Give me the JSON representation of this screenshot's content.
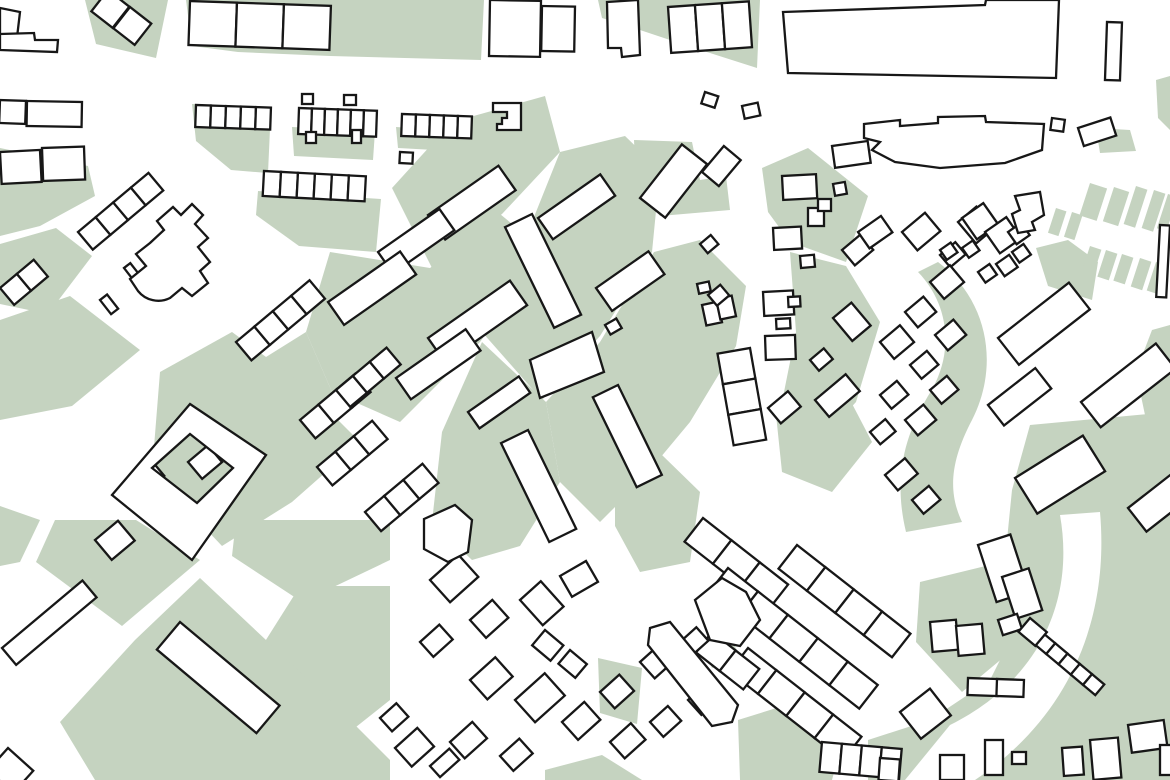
{
  "map": {
    "kind": "figure-ground-urban-map",
    "colors": {
      "background": "#ffffff",
      "open_space_green": "#c5d3c0",
      "building_fill": "#ffffff",
      "building_outline": "#171717"
    },
    "stroke_width": 2.3,
    "viewbox": "0 0 1170 780",
    "green_areas": {
      "polys": [
        "85,0 168,0 156,58 96,44",
        "186,0 484,0 481,60 330,56 238,52 192,46",
        "598,0 760,0 757,68 688,46 640,30 602,18",
        "192,104 271,107 268,173 231,170 196,141",
        "292,127 375,131 373,160 294,156",
        "396,127 474,132 471,152 398,148",
        "258,191 381,199 376,252 299,246 256,215",
        "0,148 88,166 95,196 40,226 0,236",
        "0,244 56,228 92,256 48,314 0,304",
        "392,188 452,122 545,96 560,152 502,214 432,268",
        "560,152 625,136 660,170 652,252 600,336 542,400 482,332 520,252",
        "330,252 430,268 500,214 546,252 480,342 400,422 332,392 306,332",
        "482,342 546,402 560,482 520,546 472,560 432,522 442,432",
        "560,482 546,402 600,342 654,252 700,240 746,286 736,346 690,422 640,482 600,522",
        "306,332 332,392 292,442 232,482 182,432 242,372",
        "0,320 70,296 140,350 72,406 0,420",
        "160,372 232,332 300,382 360,442 292,502 222,546 152,472",
        "55,520 136,520 200,560 122,626 36,562",
        "236,520 390,520 390,560 302,602 232,556",
        "300,586 390,586 390,700 332,746 252,662",
        "135,640 200,578 332,702 390,760 390,780 95,780 60,722",
        "0,506 40,520 20,562 0,566",
        "762,168 808,148 868,196 846,262 790,242 768,212",
        "790,252 846,266 880,322 856,402 810,452 780,412 796,332",
        "775,405 848,396 872,442 832,492 782,472",
        "615,470 662,455 700,492 690,562 640,572 615,526",
        "738,720 802,700 842,742 832,780 740,780",
        "920,582 1002,562 1022,642 962,692 916,642",
        "598,658 642,668 637,724 600,713",
        "545,770 602,755 642,780 545,780",
        "1096,128 1130,130 1136,151 1100,153",
        "1152,330 1170,325 1170,420 1145,415 1136,372",
        "634,140 692,142 700,180 726,176 730,210 660,216 636,188",
        "700,640 726,630 740,656 712,668",
        "1156,80 1170,76 1170,130 1158,118",
        "1036,248 1068,240 1098,262 1092,300 1048,286",
        "1030,425 1170,412 1170,780 868,780 868,740 930,720 990,680 1020,620 1005,560 1012,490"
      ],
      "paths": [
        "M 938,262 C 988,300 1000,365 972,420 C 950,462 948,492 962,522 L 906,532 C 894,482 902,440 928,396 C 955,355 950,305 918,272 Z"
      ],
      "strips": [
        [
          1056,
          208,
          11,
          26,
          18
        ],
        [
          1072,
          212,
          11,
          26,
          18
        ],
        [
          1090,
          183,
          18,
          34,
          18
        ],
        [
          1114,
          187,
          16,
          36,
          18
        ],
        [
          1136,
          186,
          12,
          40,
          18
        ],
        [
          1154,
          190,
          12,
          40,
          18
        ],
        [
          1168,
          194,
          10,
          36,
          18
        ],
        [
          1090,
          246,
          12,
          28,
          18
        ],
        [
          1106,
          250,
          12,
          28,
          18
        ],
        [
          1122,
          254,
          12,
          28,
          18
        ],
        [
          1140,
          258,
          12,
          30,
          18
        ],
        [
          1156,
          262,
          12,
          30,
          18
        ]
      ]
    },
    "streets": {
      "white_paths": [
        "M 1060,515 C 1075,600 1040,680 950,725 L 905,780 L 975,780 C 1065,720 1110,625 1100,512 Z"
      ]
    },
    "buildings": {
      "rows": [
        [
          190,
          1,
          47,
          44,
          3,
          2
        ],
        [
          668,
          7,
          27,
          46,
          3,
          -4
        ],
        [
          196,
          105,
          15,
          22,
          5,
          2
        ],
        [
          299,
          108,
          13,
          26,
          6,
          2
        ],
        [
          402,
          114,
          14,
          22,
          5,
          2
        ],
        [
          264,
          171,
          17,
          25,
          6,
          3
        ],
        [
          703,
          518,
          36,
          30,
          3,
          38
        ],
        [
          797,
          545,
          36,
          30,
          4,
          38
        ],
        [
          728,
          568,
          38,
          30,
          5,
          38
        ],
        [
          748,
          648,
          36,
          30,
          4,
          38
        ],
        [
          712,
          632,
          30,
          26,
          2,
          38
        ],
        [
          1043,
          633,
          16,
          14,
          5,
          40
        ],
        [
          822,
          742,
          20,
          30,
          4,
          5
        ],
        [
          750,
          348,
          31,
          33,
          3,
          80
        ],
        [
          78,
          232,
          23,
          23,
          4,
          -40
        ],
        [
          0,
          288,
          22,
          22,
          2,
          -40
        ],
        [
          236,
          342,
          24,
          24,
          4,
          -40
        ],
        [
          300,
          420,
          24,
          24,
          3,
          -40
        ],
        [
          317,
          467,
          24,
          24,
          3,
          -40
        ],
        [
          365,
          512,
          25,
          25,
          3,
          -40
        ],
        [
          336,
          390,
          22,
          22,
          3,
          -40
        ]
      ],
      "rects": [
        [
          108,
          -10,
          27,
          27,
          38
        ],
        [
          130,
          7,
          27,
          27,
          38
        ],
        [
          490,
          0,
          51,
          56,
          1
        ],
        [
          542,
          6,
          33,
          45,
          1
        ],
        [
          1107,
          22,
          15,
          58,
          2
        ],
        [
          1052,
          118,
          13,
          12,
          8
        ],
        [
          1078,
          128,
          34,
          19,
          -18
        ],
        [
          0,
          100,
          26,
          23,
          2
        ],
        [
          27,
          101,
          55,
          25,
          1
        ],
        [
          0,
          152,
          40,
          32,
          -3
        ],
        [
          42,
          148,
          42,
          33,
          -2
        ],
        [
          400,
          152,
          13,
          11,
          3
        ],
        [
          605,
          325,
          13,
          11,
          -30
        ],
        [
          702,
          305,
          16,
          21,
          -12
        ],
        [
          716,
          299,
          16,
          21,
          -12
        ],
        [
          697,
          284,
          12,
          10,
          -12
        ],
        [
          705,
          92,
          14,
          12,
          18
        ],
        [
          742,
          106,
          16,
          13,
          -12
        ],
        [
          302,
          94,
          11,
          10,
          0
        ],
        [
          344,
          95,
          12,
          10,
          0
        ],
        [
          306,
          132,
          10,
          11,
          0
        ],
        [
          352,
          130,
          9,
          13,
          0
        ],
        [
          428,
          215,
          86,
          30,
          -35
        ],
        [
          378,
          252,
          75,
          26,
          -35
        ],
        [
          328,
          302,
          88,
          28,
          -35
        ],
        [
          538,
          218,
          76,
          26,
          -35
        ],
        [
          428,
          338,
          100,
          30,
          -35
        ],
        [
          396,
          378,
          85,
          26,
          -35
        ],
        [
          596,
          288,
          64,
          28,
          -35
        ],
        [
          468,
          412,
          62,
          20,
          -35
        ],
        [
          532,
          214,
          112,
          30,
          64
        ],
        [
          528,
          430,
          110,
          30,
          64
        ],
        [
          618,
          385,
          100,
          28,
          64
        ],
        [
          998,
          338,
          90,
          34,
          -38
        ],
        [
          988,
          405,
          60,
          26,
          -38
        ],
        [
          1081,
          402,
          95,
          32,
          -38
        ],
        [
          1015,
          478,
          80,
          42,
          -32
        ],
        [
          1128,
          508,
          60,
          30,
          -38
        ],
        [
          640,
          198,
          68,
          32,
          -52
        ],
        [
          702,
          172,
          34,
          22,
          -50
        ],
        [
          2,
          648,
          105,
          22,
          -40
        ],
        [
          95,
          540,
          30,
          26,
          -40
        ],
        [
          180,
          622,
          130,
          36,
          40
        ],
        [
          8,
          748,
          34,
          30,
          42
        ],
        [
          140,
          478,
          20,
          14,
          -40
        ],
        [
          188,
          462,
          26,
          22,
          -40
        ],
        [
          124,
          268,
          8,
          18,
          -38
        ],
        [
          100,
          300,
          9,
          18,
          -38
        ],
        [
          832,
          146,
          36,
          22,
          -8
        ],
        [
          782,
          176,
          34,
          24,
          -3
        ],
        [
          833,
          184,
          12,
          12,
          -10
        ],
        [
          808,
          208,
          16,
          18,
          0
        ],
        [
          818,
          199,
          13,
          12,
          0
        ],
        [
          773,
          228,
          28,
          22,
          -3
        ],
        [
          800,
          256,
          14,
          12,
          -5
        ],
        [
          842,
          250,
          24,
          20,
          -40
        ],
        [
          858,
          232,
          28,
          20,
          -35
        ],
        [
          763,
          292,
          30,
          24,
          -3
        ],
        [
          788,
          297,
          12,
          10,
          -3
        ],
        [
          776,
          319,
          14,
          10,
          -3
        ],
        [
          765,
          336,
          30,
          24,
          -2
        ],
        [
          833,
          318,
          24,
          30,
          -40
        ],
        [
          810,
          360,
          18,
          14,
          -40
        ],
        [
          815,
          400,
          40,
          22,
          -40
        ],
        [
          768,
          408,
          26,
          20,
          -40
        ],
        [
          700,
          244,
          14,
          12,
          -40
        ],
        [
          708,
          295,
          16,
          14,
          -40
        ],
        [
          902,
          232,
          30,
          24,
          -40
        ],
        [
          940,
          255,
          20,
          16,
          -40
        ],
        [
          958,
          222,
          24,
          28,
          -40
        ],
        [
          930,
          282,
          26,
          22,
          -40
        ],
        [
          905,
          312,
          24,
          20,
          -40
        ],
        [
          880,
          342,
          26,
          22,
          -40
        ],
        [
          935,
          335,
          24,
          20,
          -40
        ],
        [
          910,
          365,
          22,
          18,
          -40
        ],
        [
          880,
          395,
          22,
          18,
          -40
        ],
        [
          905,
          420,
          24,
          20,
          -40
        ],
        [
          930,
          390,
          22,
          18,
          -40
        ],
        [
          885,
          475,
          26,
          20,
          -40
        ],
        [
          912,
          500,
          22,
          18,
          -40
        ],
        [
          870,
          432,
          20,
          16,
          -40
        ],
        [
          962,
          218,
          26,
          26,
          -35
        ],
        [
          985,
          232,
          26,
          26,
          -35
        ],
        [
          1008,
          232,
          16,
          15,
          -35
        ],
        [
          1012,
          252,
          14,
          13,
          -35
        ],
        [
          996,
          264,
          16,
          15,
          -35
        ],
        [
          978,
          272,
          14,
          13,
          -35
        ],
        [
          940,
          250,
          13,
          12,
          -35
        ],
        [
          962,
          248,
          13,
          12,
          -35
        ],
        [
          430,
          580,
          38,
          30,
          -42
        ],
        [
          470,
          620,
          30,
          24,
          -42
        ],
        [
          420,
          642,
          26,
          20,
          -42
        ],
        [
          520,
          600,
          28,
          34,
          -42
        ],
        [
          560,
          576,
          30,
          24,
          -30
        ],
        [
          470,
          680,
          34,
          26,
          -42
        ],
        [
          515,
          700,
          40,
          30,
          -42
        ],
        [
          562,
          722,
          30,
          24,
          -42
        ],
        [
          600,
          692,
          26,
          22,
          -42
        ],
        [
          640,
          662,
          28,
          22,
          -42
        ],
        [
          610,
          742,
          28,
          22,
          -42
        ],
        [
          650,
          722,
          24,
          20,
          -42
        ],
        [
          688,
          700,
          26,
          20,
          -42
        ],
        [
          450,
          742,
          30,
          22,
          -42
        ],
        [
          500,
          756,
          26,
          20,
          -42
        ],
        [
          680,
          642,
          22,
          18,
          -42
        ],
        [
          718,
          620,
          26,
          20,
          -42
        ],
        [
          545,
          630,
          24,
          20,
          40
        ],
        [
          570,
          650,
          22,
          18,
          40
        ],
        [
          380,
          718,
          22,
          18,
          -42
        ],
        [
          395,
          748,
          30,
          25,
          -42
        ],
        [
          430,
          766,
          26,
          15,
          -42
        ],
        [
          978,
          545,
          34,
          60,
          -18
        ],
        [
          1002,
          577,
          28,
          44,
          -18
        ],
        [
          998,
          620,
          20,
          16,
          -18
        ],
        [
          930,
          622,
          26,
          30,
          -5
        ],
        [
          956,
          626,
          26,
          30,
          -5
        ],
        [
          968,
          678,
          30,
          17,
          2
        ],
        [
          997,
          679,
          27,
          17,
          2
        ],
        [
          1030,
          618,
          22,
          18,
          40
        ],
        [
          900,
          712,
          38,
          34,
          -38
        ],
        [
          940,
          755,
          24,
          25,
          0
        ],
        [
          985,
          740,
          18,
          35,
          0
        ],
        [
          1012,
          752,
          14,
          12,
          0
        ],
        [
          1062,
          748,
          20,
          28,
          -4
        ],
        [
          1090,
          740,
          28,
          40,
          -5
        ],
        [
          1128,
          725,
          36,
          28,
          -8
        ],
        [
          1160,
          745,
          20,
          30,
          0
        ],
        [
          880,
          758,
          20,
          22,
          4
        ],
        [
          1160,
          225,
          10,
          72,
          3
        ]
      ],
      "polys": [
        "0,8 20,12 16,46 0,42",
        "0,34 34,33 35,40 58,40 57,52 0,50",
        "607,2 638,0 640,55 622,57 621,48 608,48",
        "783,12 985,5 986,0 1059,0 1056,78 788,73",
        "493,103 521,103 521,130 497,130 497,124 502,124 502,118 507,118 507,112 493,112",
        "1015,196 1040,192 1044,215 1032,222 1035,230 1018,233 1012,214 1020,210",
        "530,360 592,332 604,372 540,398",
        "424,519 455,505 472,520 468,552 448,562 424,549",
        "650,628 670,622 738,705 732,722 712,726 648,645",
        "695,600 722,578 746,592 760,620 740,646 710,640"
      ],
      "paths": [
        {
          "d": "M 150,243 L 164,230 L 157,221 L 173,207 L 181,215 L 192,204 L 203,215 L 195,224 L 208,238 L 198,247 L 210,262 L 200,271 L 208,283 L 192,296 L 182,288 L 170,298 A 26 26 0 0 1 138,291 L 130,279 L 146,266 L 136,254 Z",
          "fill_rule": "nonzero"
        },
        {
          "d": "M 864,124 L 900,120 L 900,126 L 938,123 L 938,117 L 985,116 L 986,122 L 1044,124 L 1042,150 L 1005,163 L 940,168 L 895,162 L 872,150 L 880,142 L 864,138 Z",
          "fill_rule": "nonzero"
        },
        {
          "d": "M 190,404 L 266,455 L 192,560 L 112,495 Z M 190,434 L 233,468 L 197,503 L 152,468 Z",
          "fill_rule": "evenodd"
        }
      ]
    }
  }
}
